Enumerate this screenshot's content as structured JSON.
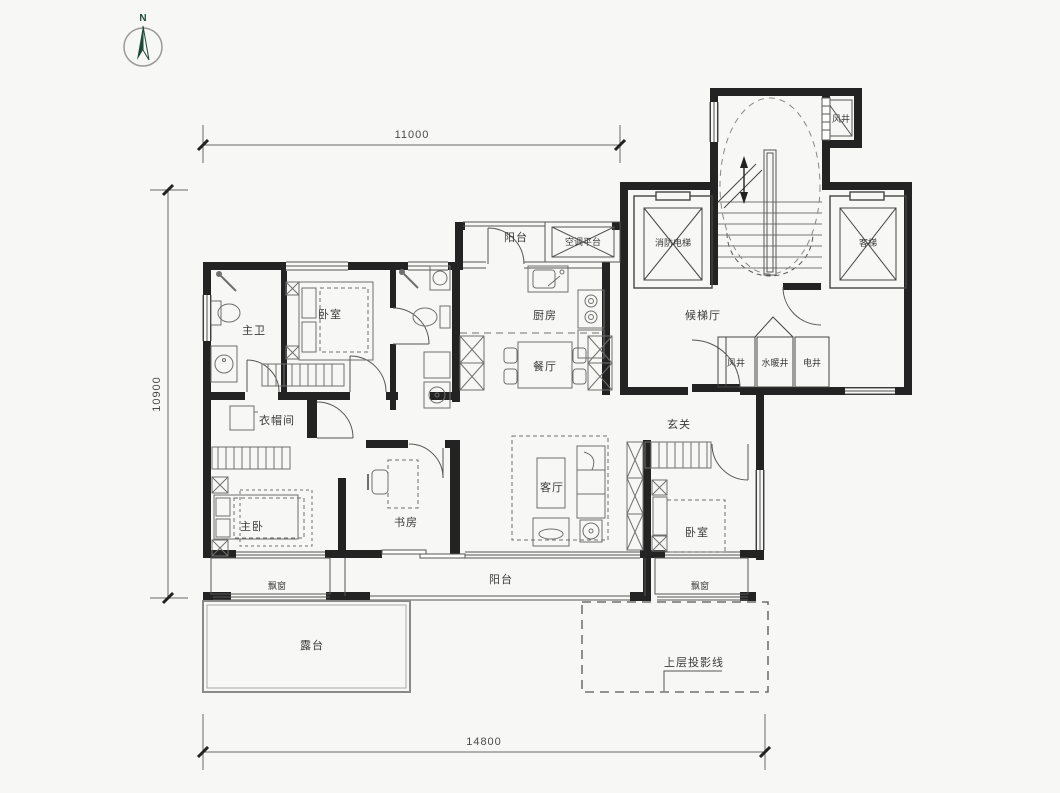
{
  "compass": {
    "label": "N"
  },
  "dimensions": {
    "top": "11000",
    "left": "10900",
    "bottom": "14800"
  },
  "rooms": {
    "balcony_top": "阳台",
    "ac_platform": "空调平台",
    "wind_shaft_top": "风井",
    "fire_elevator": "消防电梯",
    "passenger_elevator": "客梯",
    "elevator_hall": "候梯厅",
    "wind_shaft": "风井",
    "plumbing_shaft": "水暖井",
    "electric_shaft": "电井",
    "foyer": "玄关",
    "master_bath": "主卫",
    "bedroom_top": "卧室",
    "kitchen": "厨房",
    "dining": "餐厅",
    "closet": "衣帽间",
    "master_bedroom": "主卧",
    "study": "书房",
    "living": "客厅",
    "bedroom_right": "卧室",
    "bay_window_left": "飘窗",
    "bay_window_right": "飘窗",
    "balcony_bottom": "阳台",
    "terrace": "露台",
    "projection": "上层投影线"
  }
}
